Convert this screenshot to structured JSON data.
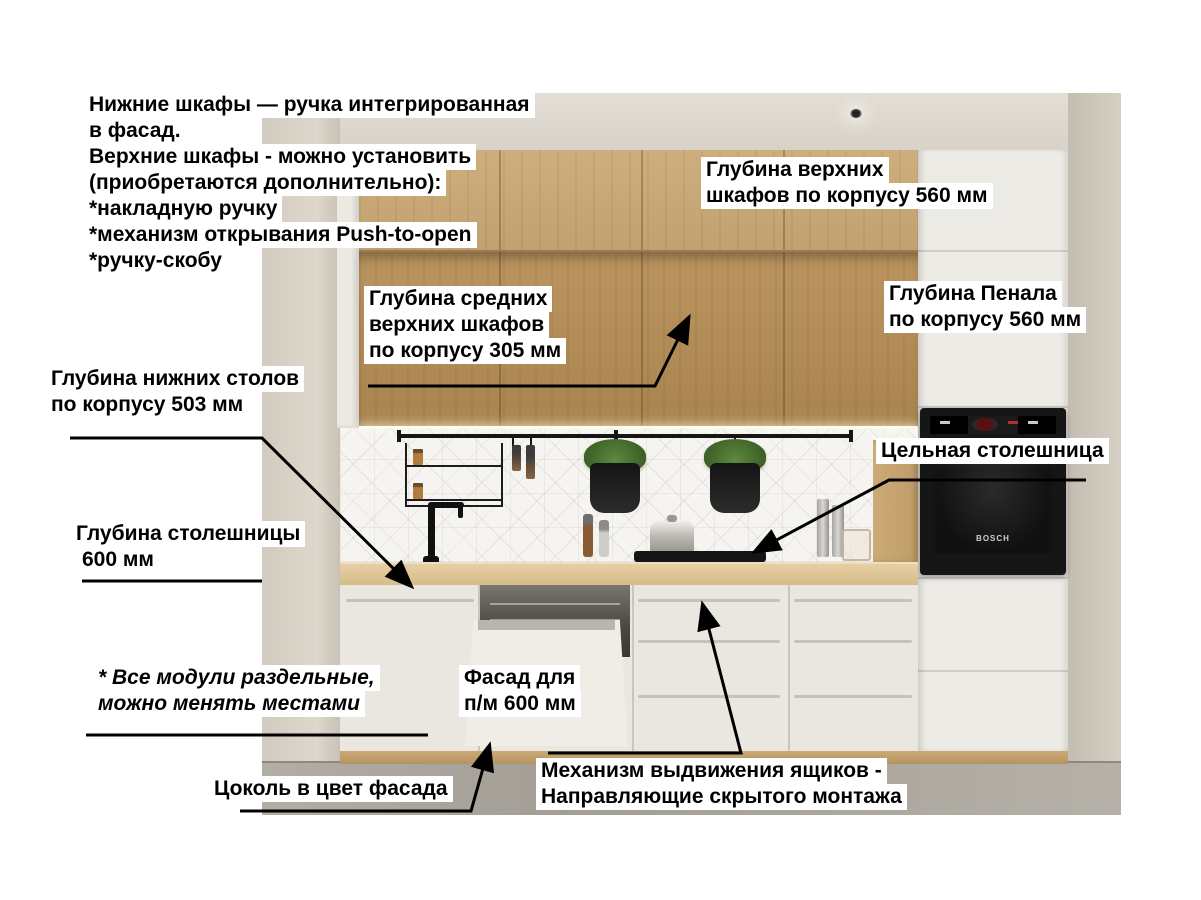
{
  "colors": {
    "label_bg": "#ffffff",
    "label_text": "#000000",
    "annotation_line": "#000000",
    "wall": "#d5cec4",
    "wood_upper_light": "#c8a875",
    "wood_upper_dark": "#ae8853",
    "countertop_wood": "#dabf92",
    "cabinet_white": "#eae7e1",
    "appliance_black": "#161616",
    "floor_gray": "#a8a39a"
  },
  "info_block": {
    "lines": [
      "Нижние шкафы — ручка интегрированная",
      "в фасад.",
      "Верхние шкафы - можно установить",
      "(приобретаются дополнительно):",
      "*накладную ручку",
      "*механизм открывания Push-to-open",
      "*ручку-скобу"
    ]
  },
  "labels": {
    "upper_depth": {
      "lines": [
        "Глубина верхних",
        "шкафов по корпусу 560 мм"
      ]
    },
    "mid_upper_depth": {
      "lines": [
        "Глубина средних",
        "верхних шкафов",
        "по корпусу 305 мм"
      ]
    },
    "penal_depth": {
      "lines": [
        "Глубина Пенала",
        "по корпусу 560 мм"
      ]
    },
    "base_depth": {
      "lines": [
        "Глубина нижних столов",
        "по корпусу 503 мм"
      ]
    },
    "countertop_depth": {
      "lines": [
        "Глубина столешницы",
        "600 мм"
      ]
    },
    "solid_countertop": {
      "lines": [
        "Цельная столешница"
      ]
    },
    "modules_note": {
      "lines": [
        "* Все модули раздельные,",
        "можно менять местами"
      ]
    },
    "dishwasher_facade": {
      "lines": [
        "Фасад для",
        "п/м 600 мм"
      ]
    },
    "plinth": {
      "lines": [
        "Цоколь в цвет фасада"
      ]
    },
    "drawer_mechanism": {
      "lines": [
        "Механизм выдвижения ящиков -",
        "Направляющие скрытого монтажа"
      ]
    }
  },
  "scene": {
    "oven_brand": "BOSCH"
  }
}
